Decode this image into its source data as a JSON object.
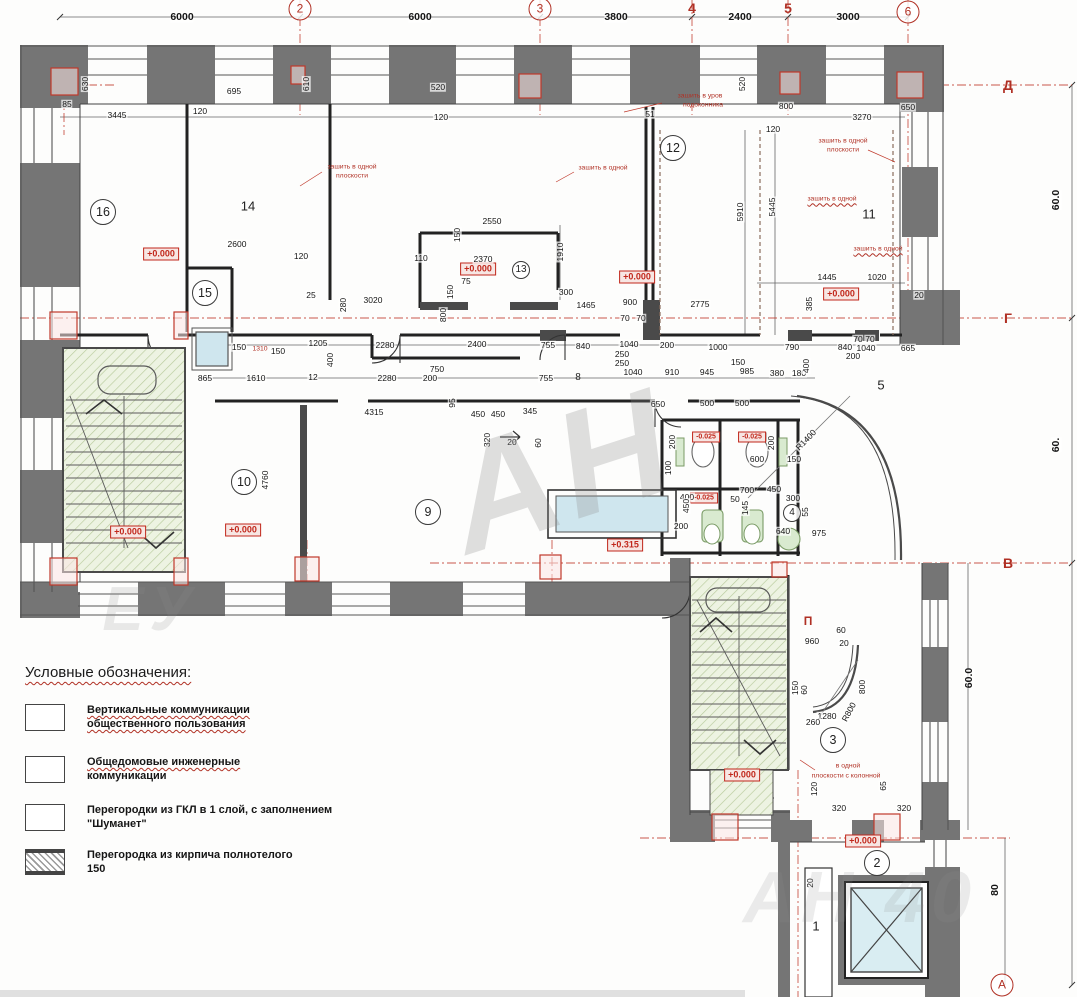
{
  "colors": {
    "wall_fill": "#757575",
    "line": "#3c3c3c",
    "red_accent": "#b03024",
    "stair_hatch_bg": "#edf3e2",
    "stair_hatch_line": "#b8cb9c",
    "shaft_blue": "#cfe6ee",
    "fixture_green": "#d9ead0"
  },
  "plan": {
    "axes": [
      {
        "t": "2",
        "x": 300,
        "y": 9,
        "c": "axisc"
      },
      {
        "t": "3",
        "x": 540,
        "y": 9,
        "c": "axisc"
      },
      {
        "t": "4",
        "x": 692,
        "y": 8,
        "c": "axis"
      },
      {
        "t": "5",
        "x": 788,
        "y": 8,
        "c": "axis"
      },
      {
        "t": "6",
        "x": 908,
        "y": 12,
        "c": "axisc"
      },
      {
        "t": "Д",
        "x": 1008,
        "y": 85,
        "c": "axis"
      },
      {
        "t": "Г",
        "x": 1008,
        "y": 318,
        "c": "axis"
      },
      {
        "t": "В",
        "x": 1008,
        "y": 563,
        "c": "axis"
      },
      {
        "t": "А",
        "x": 1002,
        "y": 985,
        "c": "axisc"
      }
    ],
    "axis_dimensions": [
      {
        "t": "6000",
        "x": 182,
        "y": 17,
        "c": "dimb"
      },
      {
        "t": "6000",
        "x": 420,
        "y": 17,
        "c": "dimb"
      },
      {
        "t": "3800",
        "x": 616,
        "y": 17,
        "c": "dimb"
      },
      {
        "t": "2400",
        "x": 740,
        "y": 17,
        "c": "dimb"
      },
      {
        "t": "3000",
        "x": 848,
        "y": 17,
        "c": "dimb"
      },
      {
        "t": "60.0",
        "x": 1056,
        "y": 200,
        "c": "dimb",
        "r": -90
      },
      {
        "t": "60.",
        "x": 1056,
        "y": 445,
        "c": "dimb",
        "r": -90
      },
      {
        "t": "60.0",
        "x": 969,
        "y": 678,
        "c": "dimb",
        "r": -90
      },
      {
        "t": "80",
        "x": 995,
        "y": 890,
        "c": "dimb",
        "r": -90
      }
    ],
    "rooms": [
      {
        "t": "16",
        "x": 103,
        "y": 212,
        "c": "roomc"
      },
      {
        "t": "14",
        "x": 248,
        "y": 206,
        "c": "room"
      },
      {
        "t": "15",
        "x": 205,
        "y": 293,
        "c": "roomc"
      },
      {
        "t": "13",
        "x": 521,
        "y": 270,
        "c": "roomcs"
      },
      {
        "t": "12",
        "x": 673,
        "y": 148,
        "c": "roomc"
      },
      {
        "t": "11",
        "x": 869,
        "y": 214,
        "c": "room"
      },
      {
        "t": "10",
        "x": 244,
        "y": 482,
        "c": "roomc"
      },
      {
        "t": "9",
        "x": 428,
        "y": 512,
        "c": "roomc"
      },
      {
        "t": "8",
        "x": 578,
        "y": 378,
        "c": "room",
        "s": 10
      },
      {
        "t": "5",
        "x": 881,
        "y": 385,
        "c": "room"
      },
      {
        "t": "4",
        "x": 792,
        "y": 513,
        "c": "roomcs"
      },
      {
        "t": "3",
        "x": 833,
        "y": 740,
        "c": "roomc"
      },
      {
        "t": "2",
        "x": 877,
        "y": 863,
        "c": "roomc"
      },
      {
        "t": "1",
        "x": 816,
        "y": 926,
        "c": "room"
      }
    ],
    "levels": [
      {
        "t": "+0.000",
        "x": 161,
        "y": 254,
        "c": "lvl"
      },
      {
        "t": "+0.000",
        "x": 478,
        "y": 269,
        "c": "lvl"
      },
      {
        "t": "+0.000",
        "x": 637,
        "y": 277,
        "c": "lvl"
      },
      {
        "t": "+0.000",
        "x": 841,
        "y": 294,
        "c": "lvl"
      },
      {
        "t": "+0.000",
        "x": 128,
        "y": 532,
        "c": "lvl"
      },
      {
        "t": "+0.000",
        "x": 243,
        "y": 530,
        "c": "lvl"
      },
      {
        "t": "+0.315",
        "x": 625,
        "y": 545,
        "c": "lvl"
      },
      {
        "t": "-0.025",
        "x": 706,
        "y": 437,
        "c": "lvl",
        "s": 7
      },
      {
        "t": "-0.025",
        "x": 752,
        "y": 437,
        "c": "lvl",
        "s": 7
      },
      {
        "t": "-0.025",
        "x": 704,
        "y": 498,
        "c": "lvl",
        "s": 7
      },
      {
        "t": "+0.000",
        "x": 742,
        "y": 775,
        "c": "lvl"
      },
      {
        "t": "+0.000",
        "x": 863,
        "y": 841,
        "c": "lvl"
      }
    ],
    "annotations": [
      {
        "t": "зашить в одной",
        "x": 352,
        "y": 168,
        "c": "red"
      },
      {
        "t": "плоскости",
        "x": 352,
        "y": 177,
        "c": "red"
      },
      {
        "t": "зашить в одной",
        "x": 603,
        "y": 169,
        "c": "red"
      },
      {
        "t": "зашить в уров",
        "x": 700,
        "y": 97,
        "c": "red"
      },
      {
        "t": "подоконника",
        "x": 703,
        "y": 106,
        "c": "red"
      },
      {
        "t": "зашить в одной",
        "x": 843,
        "y": 142,
        "c": "red"
      },
      {
        "t": "плоскости",
        "x": 843,
        "y": 151,
        "c": "red"
      },
      {
        "t": "зашить в одной",
        "x": 832,
        "y": 200,
        "c": "redw"
      },
      {
        "t": "зашить в одной",
        "x": 878,
        "y": 250,
        "c": "redw"
      },
      {
        "t": "в одной",
        "x": 848,
        "y": 767,
        "c": "red"
      },
      {
        "t": "плоскости с колонной",
        "x": 846,
        "y": 777,
        "c": "red"
      },
      {
        "t": "1310",
        "x": 260,
        "y": 350,
        "c": "red"
      },
      {
        "t": "П",
        "x": 808,
        "y": 621,
        "c": "redb"
      }
    ],
    "dimensions": [
      {
        "t": "630",
        "x": 85,
        "y": 84,
        "r": -90
      },
      {
        "t": "85",
        "x": 67,
        "y": 104
      },
      {
        "t": "695",
        "x": 234,
        "y": 91
      },
      {
        "t": "120",
        "x": 200,
        "y": 111
      },
      {
        "t": "3445",
        "x": 117,
        "y": 115
      },
      {
        "t": "610",
        "x": 306,
        "y": 84,
        "r": -90
      },
      {
        "t": "520",
        "x": 438,
        "y": 87
      },
      {
        "t": "120",
        "x": 441,
        "y": 117
      },
      {
        "t": "51",
        "x": 650,
        "y": 114
      },
      {
        "t": "520",
        "x": 742,
        "y": 84,
        "r": -90
      },
      {
        "t": "800",
        "x": 786,
        "y": 106
      },
      {
        "t": "120",
        "x": 773,
        "y": 129
      },
      {
        "t": "3270",
        "x": 862,
        "y": 117
      },
      {
        "t": "650",
        "x": 908,
        "y": 107
      },
      {
        "t": "2600",
        "x": 237,
        "y": 244
      },
      {
        "t": "120",
        "x": 301,
        "y": 256
      },
      {
        "t": "2550",
        "x": 492,
        "y": 221
      },
      {
        "t": "150",
        "x": 457,
        "y": 235,
        "r": -90
      },
      {
        "t": "2370",
        "x": 483,
        "y": 259
      },
      {
        "t": "110",
        "x": 421,
        "y": 258
      },
      {
        "t": "75",
        "x": 466,
        "y": 281
      },
      {
        "t": "150",
        "x": 450,
        "y": 292,
        "r": -90
      },
      {
        "t": "1910",
        "x": 560,
        "y": 252,
        "r": -90
      },
      {
        "t": "300",
        "x": 566,
        "y": 292
      },
      {
        "t": "1465",
        "x": 586,
        "y": 305
      },
      {
        "t": "800",
        "x": 443,
        "y": 315,
        "r": -90
      },
      {
        "t": "25",
        "x": 311,
        "y": 295
      },
      {
        "t": "5910",
        "x": 740,
        "y": 212,
        "r": -90
      },
      {
        "t": "5445",
        "x": 772,
        "y": 207,
        "r": -90
      },
      {
        "t": "1445",
        "x": 827,
        "y": 277
      },
      {
        "t": "1020",
        "x": 877,
        "y": 277
      },
      {
        "t": "385",
        "x": 809,
        "y": 304,
        "r": -90
      },
      {
        "t": "20",
        "x": 919,
        "y": 295
      },
      {
        "t": "900",
        "x": 630,
        "y": 302
      },
      {
        "t": "2775",
        "x": 700,
        "y": 304
      },
      {
        "t": "70",
        "x": 625,
        "y": 318
      },
      {
        "t": "70",
        "x": 641,
        "y": 318
      },
      {
        "t": "150",
        "x": 239,
        "y": 347
      },
      {
        "t": "150",
        "x": 278,
        "y": 351
      },
      {
        "t": "1205",
        "x": 318,
        "y": 343
      },
      {
        "t": "2280",
        "x": 385,
        "y": 345
      },
      {
        "t": "400",
        "x": 330,
        "y": 360,
        "r": -90
      },
      {
        "t": "3020",
        "x": 373,
        "y": 300
      },
      {
        "t": "280",
        "x": 343,
        "y": 305,
        "r": -90
      },
      {
        "t": "2400",
        "x": 477,
        "y": 344
      },
      {
        "t": "755",
        "x": 548,
        "y": 345
      },
      {
        "t": "840",
        "x": 583,
        "y": 346
      },
      {
        "t": "1040",
        "x": 629,
        "y": 344
      },
      {
        "t": "200",
        "x": 667,
        "y": 345
      },
      {
        "t": "1000",
        "x": 718,
        "y": 347
      },
      {
        "t": "790",
        "x": 792,
        "y": 347
      },
      {
        "t": "840",
        "x": 845,
        "y": 347
      },
      {
        "t": "70",
        "x": 858,
        "y": 339
      },
      {
        "t": "70",
        "x": 870,
        "y": 339
      },
      {
        "t": "1040",
        "x": 866,
        "y": 348
      },
      {
        "t": "200",
        "x": 853,
        "y": 356
      },
      {
        "t": "665",
        "x": 908,
        "y": 348
      },
      {
        "t": "250",
        "x": 622,
        "y": 354
      },
      {
        "t": "250",
        "x": 622,
        "y": 363
      },
      {
        "t": "1040",
        "x": 633,
        "y": 372
      },
      {
        "t": "910",
        "x": 672,
        "y": 372
      },
      {
        "t": "945",
        "x": 707,
        "y": 372
      },
      {
        "t": "985",
        "x": 747,
        "y": 371
      },
      {
        "t": "380",
        "x": 777,
        "y": 373
      },
      {
        "t": "180",
        "x": 799,
        "y": 373
      },
      {
        "t": "150",
        "x": 738,
        "y": 362
      },
      {
        "t": "400",
        "x": 806,
        "y": 366,
        "r": -90
      },
      {
        "t": "750",
        "x": 437,
        "y": 369
      },
      {
        "t": "200",
        "x": 430,
        "y": 378
      },
      {
        "t": "865",
        "x": 205,
        "y": 378
      },
      {
        "t": "1610",
        "x": 256,
        "y": 378
      },
      {
        "t": "12",
        "x": 313,
        "y": 377
      },
      {
        "t": "2280",
        "x": 387,
        "y": 378
      },
      {
        "t": "755",
        "x": 546,
        "y": 378
      },
      {
        "t": "650",
        "x": 658,
        "y": 404
      },
      {
        "t": "500",
        "x": 707,
        "y": 403
      },
      {
        "t": "500",
        "x": 742,
        "y": 403
      },
      {
        "t": "4315",
        "x": 374,
        "y": 412
      },
      {
        "t": "95",
        "x": 452,
        "y": 403,
        "r": -90
      },
      {
        "t": "450",
        "x": 478,
        "y": 414
      },
      {
        "t": "450",
        "x": 498,
        "y": 414
      },
      {
        "t": "345",
        "x": 530,
        "y": 411
      },
      {
        "t": "20",
        "x": 512,
        "y": 442
      },
      {
        "t": "60",
        "x": 538,
        "y": 443,
        "r": -90
      },
      {
        "t": "320",
        "x": 487,
        "y": 440,
        "r": -90
      },
      {
        "t": "4760",
        "x": 265,
        "y": 480,
        "r": -90
      },
      {
        "t": "200",
        "x": 672,
        "y": 442,
        "r": -90
      },
      {
        "t": "200",
        "x": 771,
        "y": 443,
        "r": -90
      },
      {
        "t": "100",
        "x": 668,
        "y": 468,
        "r": -90
      },
      {
        "t": "600",
        "x": 757,
        "y": 459
      },
      {
        "t": "150",
        "x": 794,
        "y": 459
      },
      {
        "t": "700",
        "x": 747,
        "y": 490
      },
      {
        "t": "450",
        "x": 774,
        "y": 489
      },
      {
        "t": "300",
        "x": 793,
        "y": 498
      },
      {
        "t": "400",
        "x": 687,
        "y": 497
      },
      {
        "t": "50",
        "x": 735,
        "y": 499
      },
      {
        "t": "145",
        "x": 745,
        "y": 508,
        "r": -90
      },
      {
        "t": "450",
        "x": 686,
        "y": 506,
        "r": -90
      },
      {
        "t": "200",
        "x": 681,
        "y": 526
      },
      {
        "t": "640",
        "x": 783,
        "y": 531
      },
      {
        "t": "975",
        "x": 819,
        "y": 533
      },
      {
        "t": "55",
        "x": 805,
        "y": 512,
        "r": -90
      },
      {
        "t": "R1400",
        "x": 806,
        "y": 440,
        "r": -46
      },
      {
        "t": "960",
        "x": 812,
        "y": 641
      },
      {
        "t": "60",
        "x": 841,
        "y": 630
      },
      {
        "t": "20",
        "x": 844,
        "y": 643
      },
      {
        "t": "800",
        "x": 862,
        "y": 687,
        "r": -90
      },
      {
        "t": "R800",
        "x": 849,
        "y": 712,
        "r": -62
      },
      {
        "t": "1280",
        "x": 827,
        "y": 716
      },
      {
        "t": "260",
        "x": 813,
        "y": 722
      },
      {
        "t": "150",
        "x": 795,
        "y": 688,
        "r": -90
      },
      {
        "t": "60",
        "x": 804,
        "y": 690,
        "r": -90
      },
      {
        "t": "120",
        "x": 814,
        "y": 789,
        "r": -90
      },
      {
        "t": "65",
        "x": 883,
        "y": 786,
        "r": -90
      },
      {
        "t": "320",
        "x": 839,
        "y": 808
      },
      {
        "t": "320",
        "x": 904,
        "y": 808
      },
      {
        "t": "20",
        "x": 810,
        "y": 883,
        "r": -90
      }
    ],
    "watermarks": [
      {
        "t": "АН",
        "x": 560,
        "y": 470,
        "c": "wm",
        "s": 150,
        "r": -18,
        "o": 0.28
      },
      {
        "t": "АН 40",
        "x": 860,
        "y": 898,
        "c": "wm",
        "s": 72,
        "o": 0.16
      },
      {
        "t": "ЕУ",
        "x": 150,
        "y": 610,
        "c": "wm",
        "s": 62,
        "o": 0.18
      }
    ]
  },
  "legend": {
    "title": "Условные обозначения:",
    "items": [
      {
        "swatch": "outline",
        "line1": "Вертикальные коммуникации",
        "line2": "общественного пользования"
      },
      {
        "swatch": "outline",
        "line1": "Общедомовые инженерные",
        "line2": "коммуникации"
      },
      {
        "swatch": "outline",
        "line1": "Перегородки из ГКЛ в 1 слой, с заполнением",
        "line2": "\"Шуманет\""
      },
      {
        "swatch": "hatch",
        "line1": "Перегородка из кирпича полнотелого",
        "line2": "150"
      }
    ]
  }
}
